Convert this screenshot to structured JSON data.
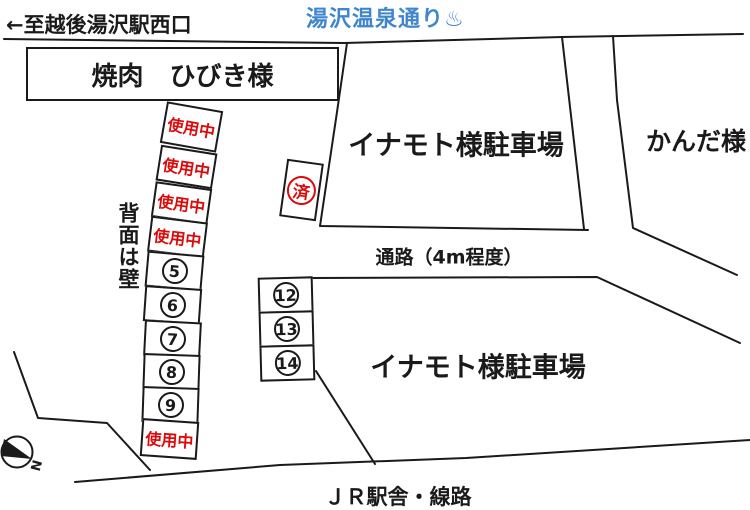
{
  "colors": {
    "outline": "#1a1a1a",
    "red": "#dc0a0a",
    "blue": "#3f86cc",
    "background": "#ffffff"
  },
  "top": {
    "station_direction": "←至越後湯沢駅西口",
    "street_title": "湯沢温泉通り♨"
  },
  "lots": {
    "yakiniku": "焼肉　ひびき様",
    "inamoto_upper": "イナモト様駐車場",
    "inamoto_lower": "イナモト様駐車場",
    "kanda": "かんだ様"
  },
  "notes": {
    "wall": "背面は壁",
    "passage": "通路（4m程度）",
    "jr": "ＪＲ駅舎・線路",
    "compass_n": "N"
  },
  "parking": {
    "in_use_text": "使用中",
    "done_text": "済",
    "left_numbers": [
      "5",
      "6",
      "7",
      "8",
      "9"
    ],
    "middle_numbers": [
      "12",
      "13",
      "14"
    ]
  }
}
